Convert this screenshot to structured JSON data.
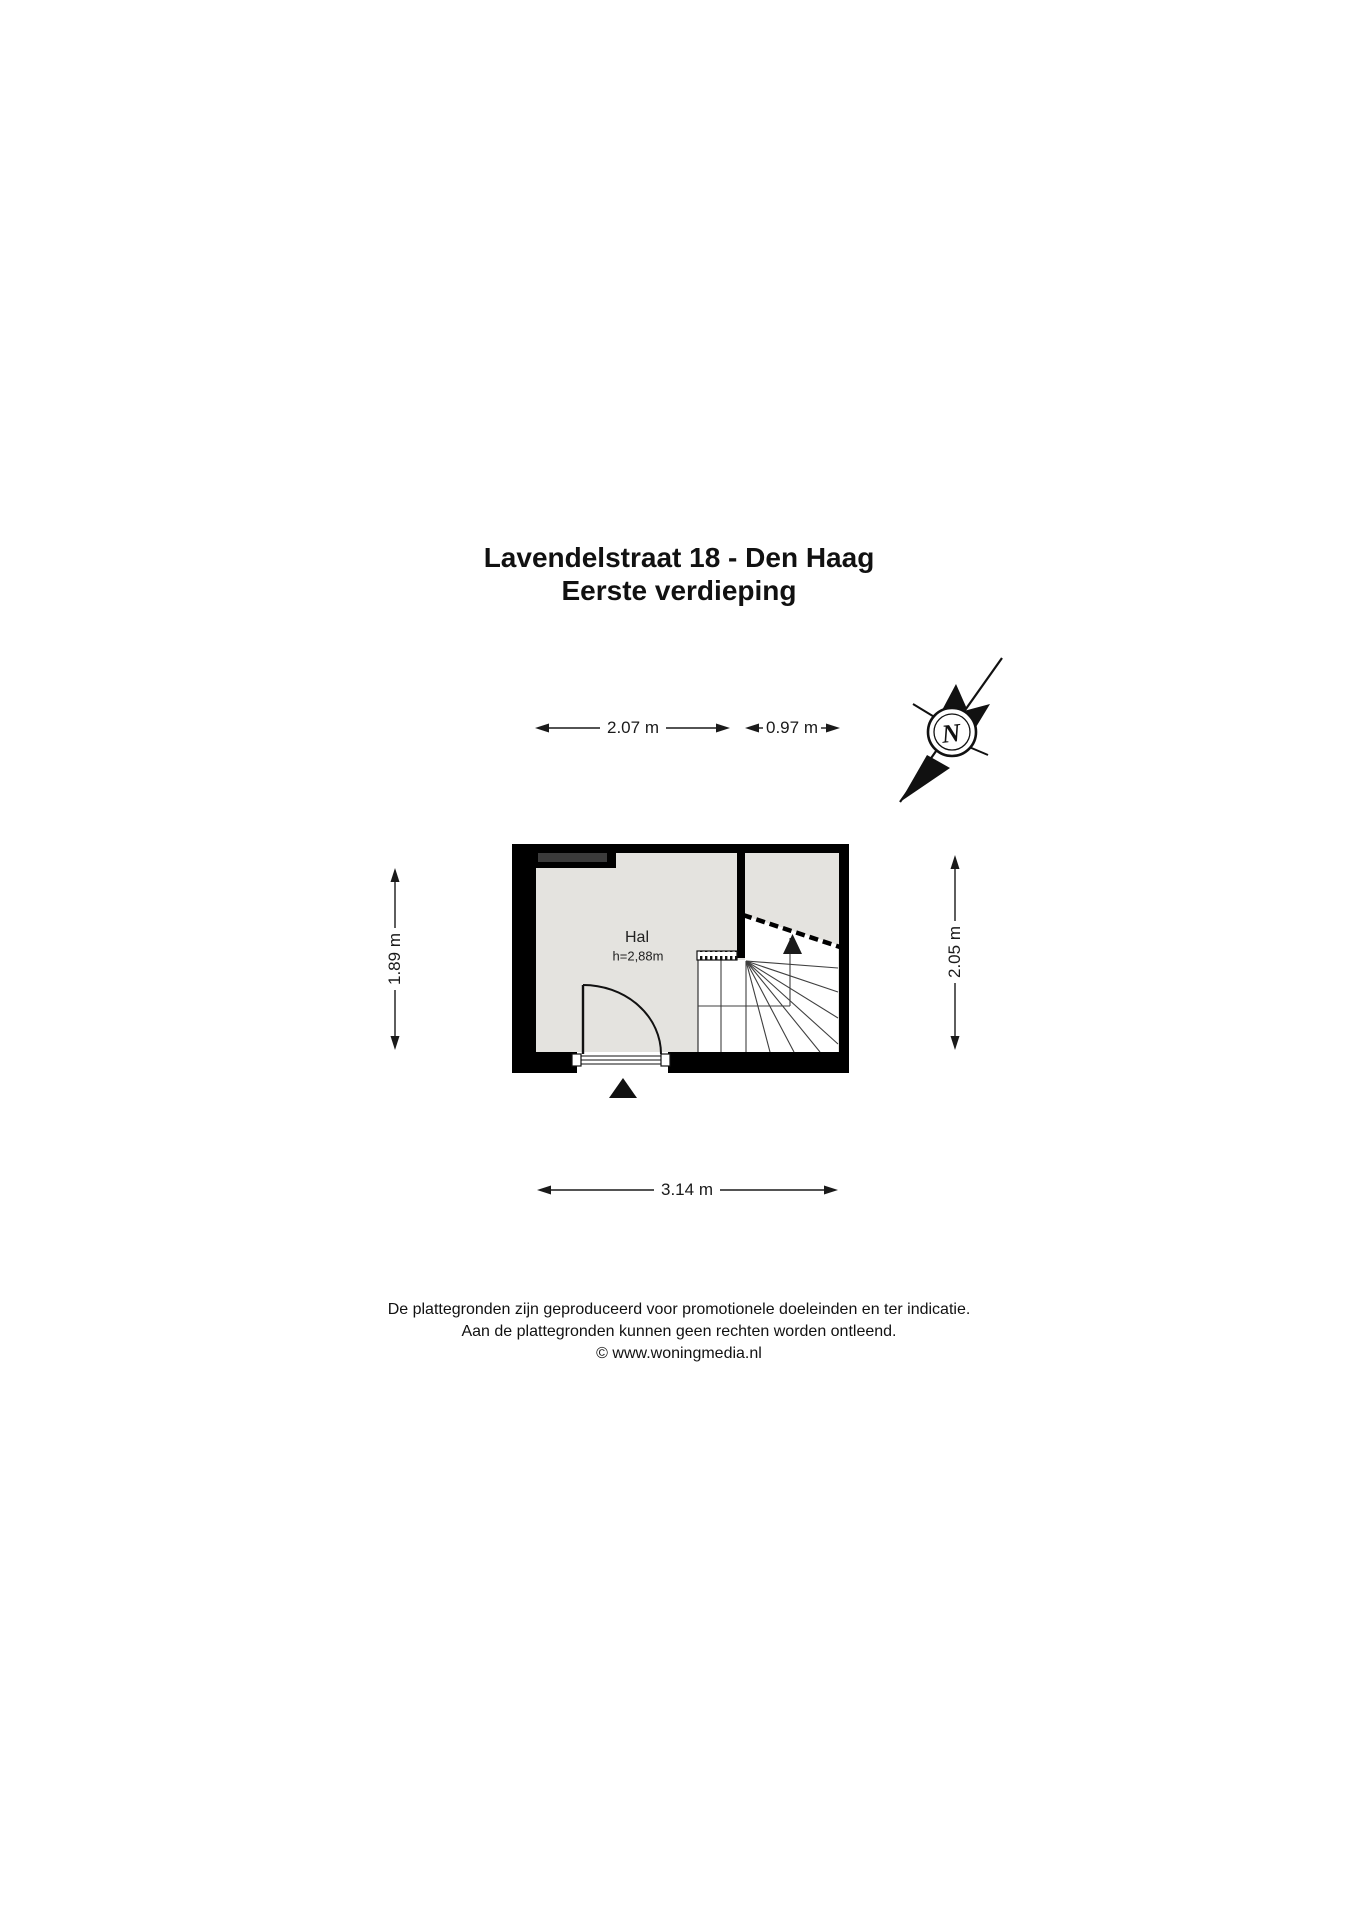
{
  "title": {
    "line1": "Lavendelstraat 18 - Den Haag",
    "line2": "Eerste verdieping"
  },
  "room": {
    "name": "Hal",
    "ceiling_height": "h=2,88m"
  },
  "dimensions": {
    "top_left": "2.07 m",
    "top_right": "0.97 m",
    "left": "1.89 m",
    "right": "2.05 m",
    "bottom": "3.14 m"
  },
  "compass": {
    "north_letter": "N"
  },
  "footer": {
    "line1": "De plattegronden zijn geproduceerd voor promotionele doeleinden en ter indicatie.",
    "line2": "Aan de plattegronden kunnen geen rechten worden ontleend.",
    "line3": "© www.woningmedia.nl"
  },
  "colors": {
    "wall": "#000000",
    "floor": "#e4e3df",
    "niche_bar": "#3b3b3b",
    "stair_line": "#3f3f3f",
    "text": "#111111"
  }
}
